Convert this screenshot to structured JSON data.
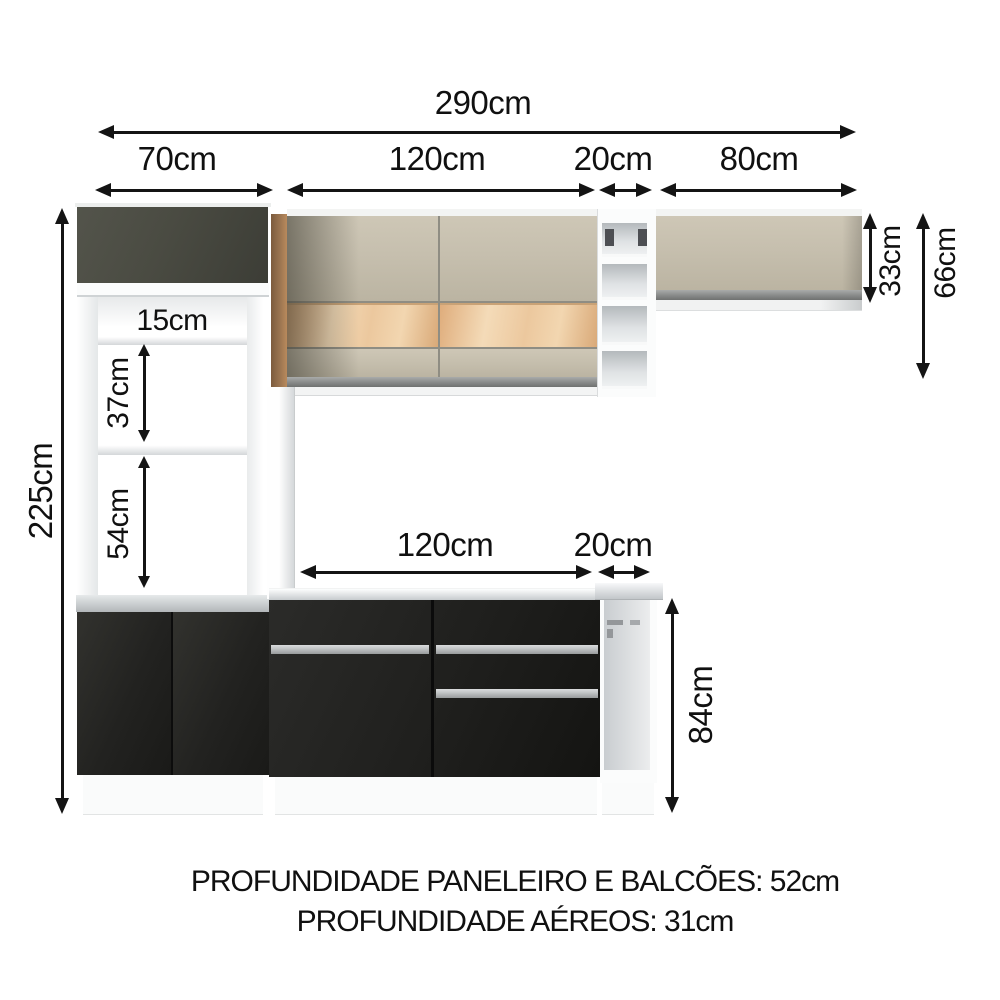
{
  "dims": {
    "total_width": "290cm",
    "tall_cabinet_width": "70cm",
    "upper_cabinet_width": "120cm",
    "upper_niche_width": "20cm",
    "right_cabinet_width": "80cm",
    "tall_cabinet_height": "225cm",
    "shelf_gap_top": "15cm",
    "shelf_gap_middle": "37cm",
    "shelf_gap_bottom": "54cm",
    "counter_width": "120cm",
    "counter_niche_width": "20cm",
    "counter_height": "84cm",
    "right_cabinet_height": "33cm",
    "upper_section_height": "66cm"
  },
  "footer": {
    "line1": "PROFUNDIDADE PANELEIRO E BALCÕES: 52cm",
    "line2": "PROFUNDIDADE AÉREOS: 31cm"
  },
  "colors": {
    "arrow": "#141414",
    "text": "#101010",
    "olive_door": "#4a4b42",
    "dark_base": "#222220",
    "counter_front": "#1f1f1d",
    "cream": "#c6bfae",
    "wood_strip": "#ecc89e",
    "wood_side": "#9a7450",
    "silver_rail": "#8e908f",
    "handle": "#c2c5c6",
    "countertop": "#c7cbce",
    "niche_interior": "#c9cdd0",
    "frame_white": "#fbfcfc"
  }
}
